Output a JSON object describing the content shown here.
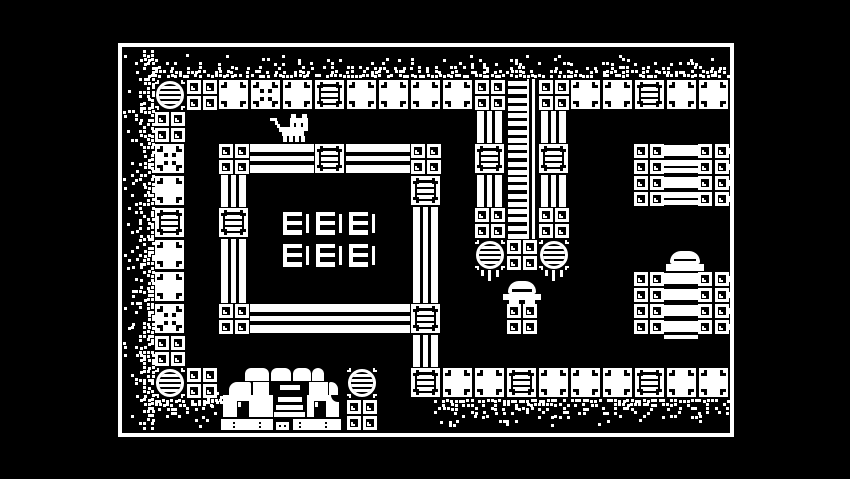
{
  "app": {
    "description": "1-bit monochrome pixel-art adventure game room (no HUD text visible)",
    "colors": {
      "background": "#000000",
      "foreground": "#ffffff"
    }
  },
  "viewport": {
    "x": 118,
    "y": 43,
    "width": 616,
    "height": 394,
    "border_px": 4
  },
  "grid": {
    "origin_x": 122,
    "origin_y": 47,
    "tile_px": 32,
    "cols": 19,
    "rows": 12
  },
  "legend": {
    "plain": "white stone block with corner notches",
    "dice": "white stone block with four center dots",
    "crate": "framed crate block with ladder rungs",
    "smallblocks": "2x2 cluster of small framed blocks",
    "medallion": "round striped medallion tile",
    "bulb": "round striped medallion with dripping ends",
    "hbeam": "horizontal striped beam",
    "vbeam": "vertical striped beam",
    "ladder": "ladder / chain strip with side rails"
  },
  "tilemap": [
    [
      1,
      1,
      "medallion"
    ],
    [
      2,
      1,
      "smallblocks"
    ],
    [
      3,
      1,
      "plain"
    ],
    [
      4,
      1,
      "dice"
    ],
    [
      5,
      1,
      "plain"
    ],
    [
      6,
      1,
      "crate"
    ],
    [
      7,
      1,
      "plain"
    ],
    [
      8,
      1,
      "plain"
    ],
    [
      9,
      1,
      "plain"
    ],
    [
      10,
      1,
      "plain"
    ],
    [
      11,
      1,
      "smallblocks"
    ],
    [
      12,
      1,
      "ladder"
    ],
    [
      13,
      1,
      "smallblocks"
    ],
    [
      14,
      1,
      "plain"
    ],
    [
      15,
      1,
      "plain"
    ],
    [
      16,
      1,
      "crate"
    ],
    [
      17,
      1,
      "plain"
    ],
    [
      18,
      1,
      "plain"
    ],
    [
      1,
      2,
      "smallblocks"
    ],
    [
      1,
      3,
      "dice"
    ],
    [
      1,
      4,
      "plain"
    ],
    [
      1,
      5,
      "crate"
    ],
    [
      1,
      6,
      "plain"
    ],
    [
      1,
      7,
      "plain"
    ],
    [
      1,
      8,
      "dice"
    ],
    [
      1,
      9,
      "smallblocks"
    ],
    [
      1,
      10,
      "medallion"
    ],
    [
      2,
      10,
      "smallblocks"
    ],
    [
      3,
      3,
      "smallblocks"
    ],
    [
      4,
      3,
      "hbeam"
    ],
    [
      5,
      3,
      "hbeam"
    ],
    [
      6,
      3,
      "crate"
    ],
    [
      7,
      3,
      "hbeam"
    ],
    [
      8,
      3,
      "hbeam"
    ],
    [
      9,
      3,
      "smallblocks"
    ],
    [
      3,
      4,
      "vbeam"
    ],
    [
      9,
      4,
      "crate"
    ],
    [
      3,
      5,
      "crate"
    ],
    [
      9,
      5,
      "vbeam"
    ],
    [
      3,
      6,
      "vbeam"
    ],
    [
      9,
      6,
      "vbeam"
    ],
    [
      3,
      7,
      "vbeam"
    ],
    [
      9,
      7,
      "vbeam"
    ],
    [
      3,
      8,
      "smallblocks"
    ],
    [
      4,
      8,
      "hbeam"
    ],
    [
      5,
      8,
      "hbeam"
    ],
    [
      6,
      8,
      "hbeam"
    ],
    [
      7,
      8,
      "hbeam"
    ],
    [
      8,
      8,
      "hbeam"
    ],
    [
      9,
      8,
      "crate"
    ],
    [
      9,
      9,
      "vbeam"
    ],
    [
      9,
      10,
      "crate"
    ],
    [
      11,
      2,
      "vbeam"
    ],
    [
      11,
      3,
      "crate"
    ],
    [
      11,
      4,
      "vbeam"
    ],
    [
      11,
      5,
      "smallblocks"
    ],
    [
      11,
      6,
      "bulb"
    ],
    [
      12,
      2,
      "ladder"
    ],
    [
      12,
      3,
      "ladder"
    ],
    [
      12,
      4,
      "ladder"
    ],
    [
      12,
      5,
      "ladder"
    ],
    [
      12,
      6,
      "smallblocks"
    ],
    [
      12,
      8,
      "smallblocks"
    ],
    [
      13,
      2,
      "vbeam"
    ],
    [
      13,
      3,
      "crate"
    ],
    [
      13,
      4,
      "vbeam"
    ],
    [
      13,
      5,
      "smallblocks"
    ],
    [
      13,
      6,
      "bulb"
    ],
    [
      10,
      10,
      "plain"
    ],
    [
      11,
      10,
      "plain"
    ],
    [
      12,
      10,
      "crate"
    ],
    [
      13,
      10,
      "plain"
    ],
    [
      14,
      10,
      "plain"
    ],
    [
      15,
      10,
      "plain"
    ],
    [
      16,
      10,
      "crate"
    ],
    [
      17,
      10,
      "plain"
    ],
    [
      18,
      10,
      "plain"
    ],
    [
      7,
      10,
      "medallion"
    ],
    [
      7,
      11,
      "smallblocks"
    ]
  ],
  "dotgrid": {
    "x": 128,
    "y": 128,
    "w": 160,
    "h": 128
  },
  "tables": {
    "w": 29,
    "h": 26,
    "positions": [
      [
        161,
        165
      ],
      [
        194,
        165
      ],
      [
        227,
        165
      ],
      [
        161,
        197
      ],
      [
        194,
        197
      ],
      [
        227,
        197
      ]
    ]
  },
  "shelves": [
    {
      "x": 512,
      "y": 96,
      "bars": [
        "thick",
        "thin2",
        "thick",
        "thin2"
      ],
      "tail_bar": false
    },
    {
      "x": 512,
      "y": 224,
      "bars": [
        "thick",
        "thick",
        "thick",
        "thick"
      ],
      "tail_bar": true
    }
  ],
  "sprites": [
    {
      "t": "cat",
      "x": 144,
      "y": 67
    },
    {
      "t": "mushroom",
      "x": 381,
      "y": 234
    },
    {
      "t": "dome",
      "x": 544,
      "y": 204
    },
    {
      "t": "building",
      "x": 99,
      "y": 315
    }
  ],
  "dirt_bands": [
    {
      "x": 32,
      "y": 7,
      "w": 576,
      "h": 25,
      "side": "bottom",
      "p": 0.9
    },
    {
      "x": 1,
      "y": 3,
      "w": 31,
      "h": 382,
      "side": "right",
      "p": 0.9
    },
    {
      "x": 32,
      "y": 352,
      "w": 68,
      "h": 25,
      "side": "top",
      "p": 0.85
    },
    {
      "x": 312,
      "y": 352,
      "w": 296,
      "h": 27,
      "side": "top",
      "p": 0.85
    },
    {
      "x": 77,
      "y": 345,
      "w": 23,
      "h": 36,
      "side": "top",
      "p": 0.5
    },
    {
      "x": 314,
      "y": 373,
      "w": 30,
      "h": 10,
      "side": "top",
      "p": 0.5
    }
  ]
}
